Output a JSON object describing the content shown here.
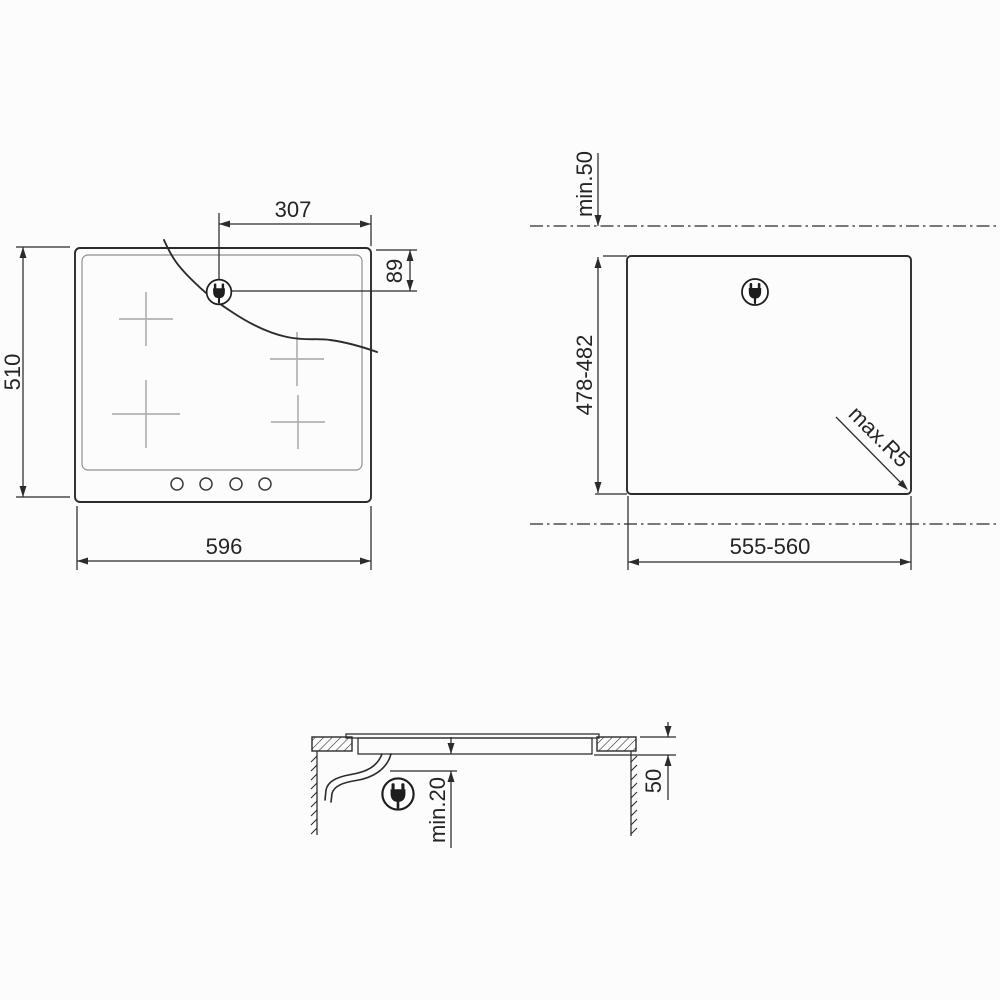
{
  "drawing": {
    "title": "Built-in hob installation diagram",
    "views": {
      "top": {
        "name": "hob-top-view",
        "dims": {
          "plug_offset_x": "307",
          "plug_offset_y": "89",
          "hob_depth": "510",
          "hob_width": "596"
        },
        "burner_marks_count": 4,
        "control_knobs_count": 4
      },
      "cutout": {
        "name": "worktop-cutout-view",
        "dims": {
          "rear_clearance": "min.50",
          "cutout_depth": "478-482",
          "corner_radius": "max.R5",
          "cutout_width": "555-560"
        }
      },
      "section": {
        "name": "worktop-section-view",
        "dims": {
          "bottom_clearance": "min.20",
          "worktop_thickness": "50"
        }
      }
    },
    "icons": {
      "power_plug": "power-plug-icon"
    },
    "colors": {
      "line": "#2b2b2b",
      "light_line": "#b2b2b2",
      "background": "#fcfcfc"
    }
  }
}
